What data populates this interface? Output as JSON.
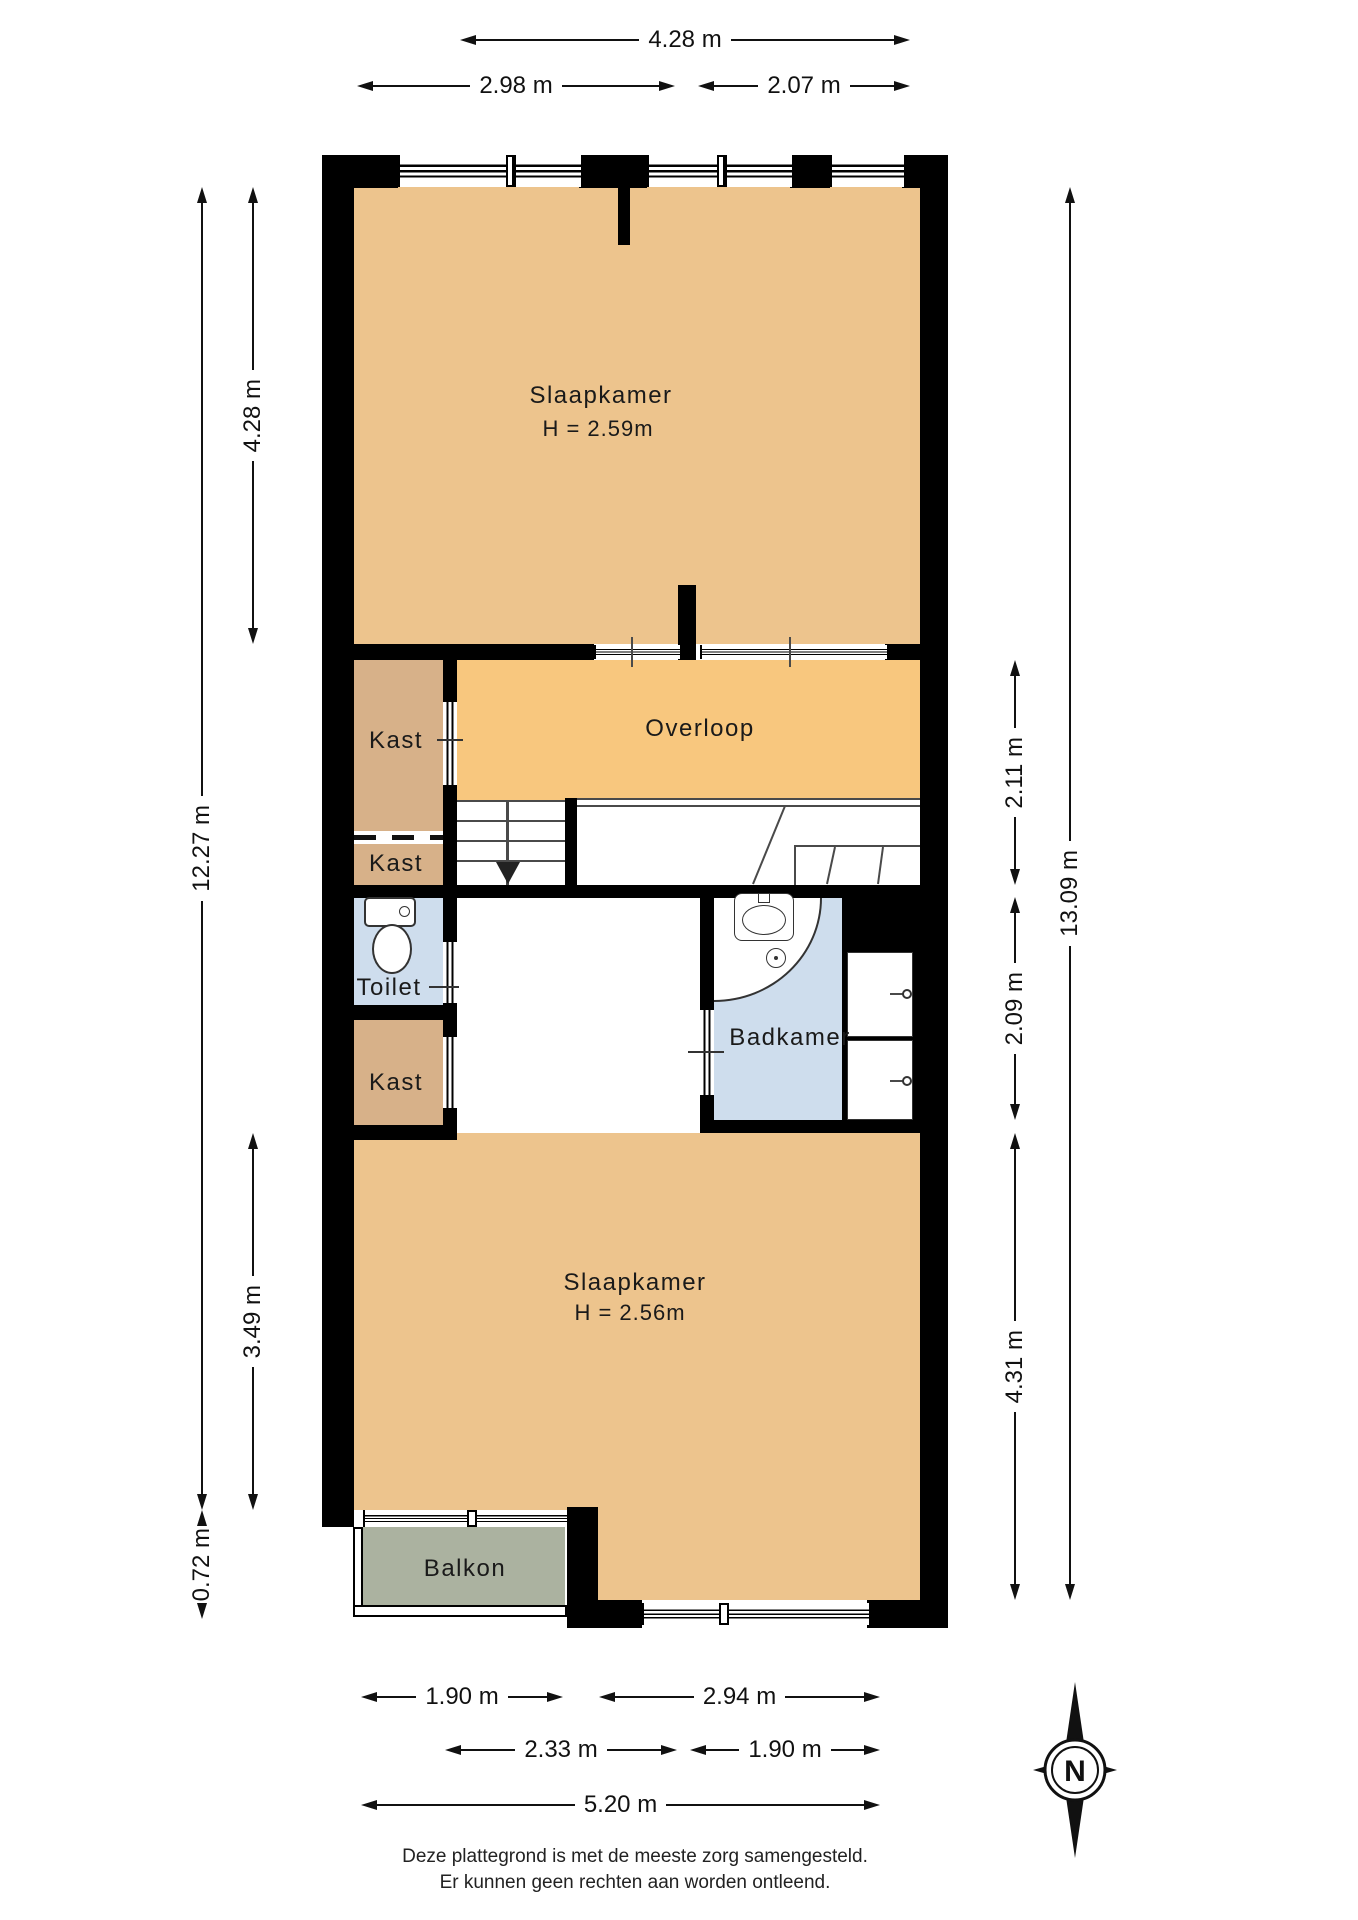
{
  "rooms": {
    "slaapkamer_top": {
      "name": "Slaapkamer",
      "ceiling": "H = 2.59m"
    },
    "overloop": {
      "name": "Overloop"
    },
    "kast_1": {
      "name": "Kast"
    },
    "kast_2": {
      "name": "Kast"
    },
    "kast_3": {
      "name": "Kast"
    },
    "toilet": {
      "name": "Toilet"
    },
    "badkamer": {
      "name": "Badkamer"
    },
    "slaapkamer_bottom": {
      "name": "Slaapkamer",
      "ceiling": "H = 2.56m"
    },
    "balkon": {
      "name": "Balkon"
    }
  },
  "dims": {
    "top_total": "4.28 m",
    "top_left": "2.98 m",
    "top_right": "2.07 m",
    "side_left_room": "4.28 m",
    "side_left_total": "12.27 m",
    "side_left_lower": "3.49 m",
    "side_left_balkon": "0.72 m",
    "side_right_overloop": "2.11 m",
    "side_right_total": "13.09 m",
    "side_right_badkamer": "2.09 m",
    "side_right_room": "4.31 m",
    "bottom_balkon": "1.90 m",
    "bottom_window": "2.94 m",
    "bottom_left": "2.33 m",
    "bottom_right": "1.90 m",
    "bottom_total": "5.20 m"
  },
  "compass": {
    "north_label": "N"
  },
  "footer": {
    "line1": "Deze plattegrond is met de meeste zorg samengesteld.",
    "line2": "Er kunnen geen rechten aan worden ontleend."
  },
  "colors": {
    "wall": "#000000",
    "floor_room": "#edc48d",
    "floor_hall": "#f8c77e",
    "floor_closet": "#d7b189",
    "floor_wet": "#cedded",
    "floor_balcony": "#abb2a0",
    "line": "#333333",
    "text": "#1a1a1a"
  }
}
